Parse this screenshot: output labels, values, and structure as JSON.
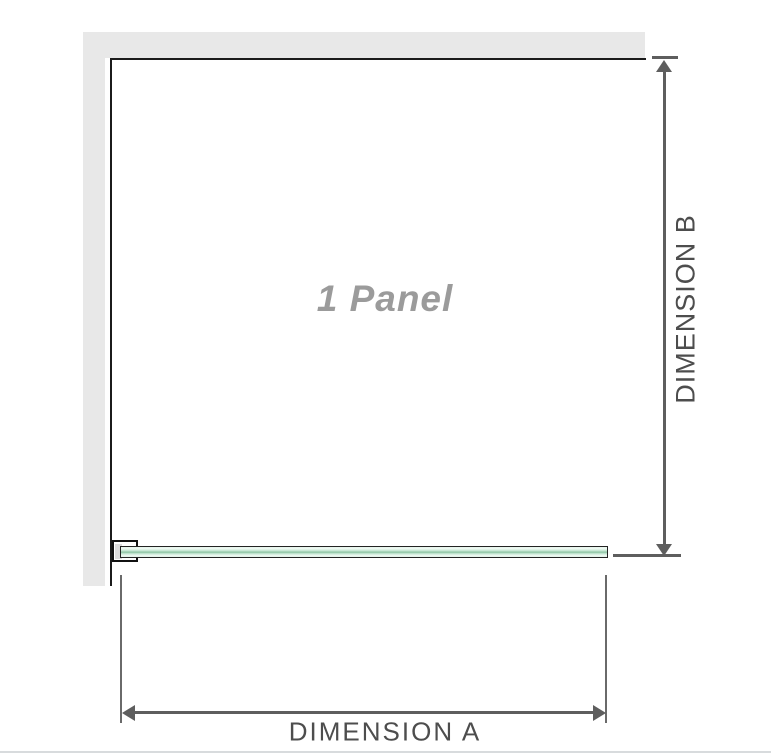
{
  "diagram": {
    "panel_label": "1 Panel",
    "dimension_a_label": "DIMENSION A",
    "dimension_b_label": "DIMENSION B",
    "colors": {
      "wall": "#e8e8e8",
      "frame_line": "#1b1b1b",
      "glass_green_light": "#d8efe2",
      "glass_green_mid": "#8cc3a3",
      "glass_border": "#232323",
      "dimension_line": "#5e5e5e",
      "dimension_text": "#4d4d4d",
      "panel_text": "#9b9b9b",
      "bottom_divider": "#d8dbdd"
    }
  }
}
